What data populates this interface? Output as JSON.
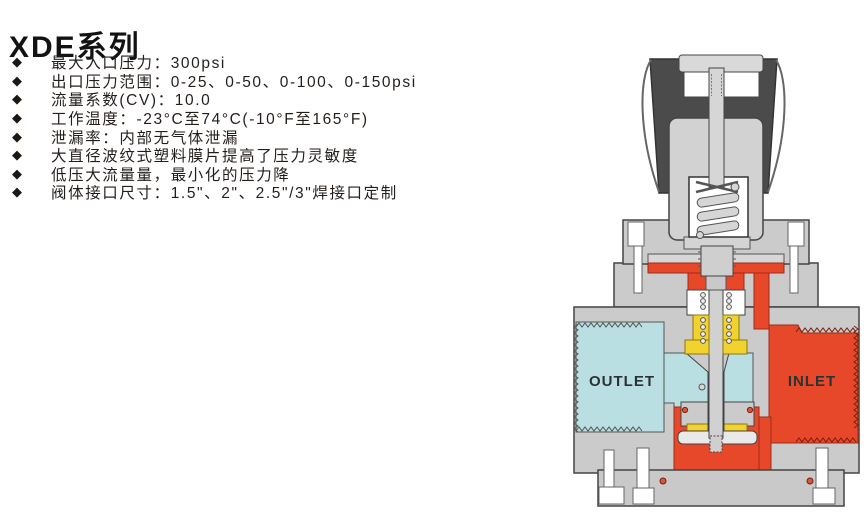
{
  "page": {
    "title": "XDE系列",
    "background": "#ffffff"
  },
  "features": {
    "marker": "◆",
    "items": [
      "最大入口压力：300psi",
      "出口压力范围：0-25、0-50、0-100、0-150psi",
      "流量系数(CV)：10.0",
      "工作温度：-23°C至74°C(-10°F至165°F)",
      "泄漏率：内部无气体泄漏",
      "大直径波纹式塑料膜片提高了压力灵敏度",
      "低压大流量量，最小化的压力降",
      "阀体接口尺寸：1.5\"、2\"、2.5\"/3\"焊接口定制"
    ]
  },
  "diagram": {
    "description": "pressure-regulator-cross-section",
    "outlet_label": "OUTLET",
    "inlet_label": "INLET",
    "colors": {
      "knob_dark": "#4b4b4b",
      "body_gray": "#cbcbcb",
      "outlet_cyan": "#badfe2",
      "inlet_red": "#e8482a",
      "seal_yellow": "#f2d22e",
      "outline": "#444444"
    }
  }
}
